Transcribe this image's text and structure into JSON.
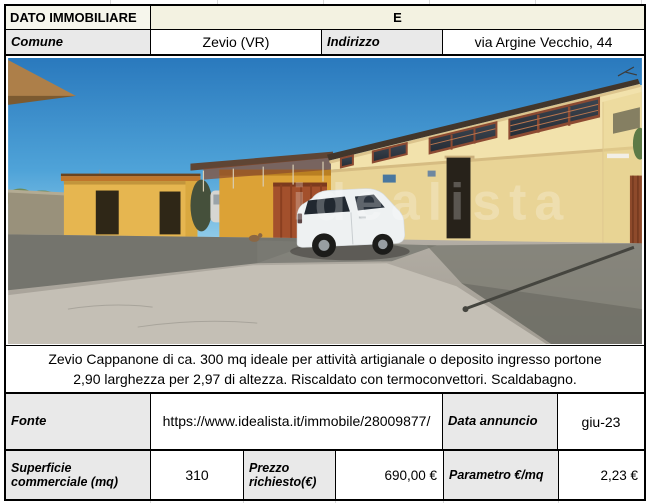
{
  "header": {
    "title": "DATO IMMOBILIARE",
    "energy_class": "E"
  },
  "location": {
    "comune_label": "Comune",
    "comune_value": "Zevio (VR)",
    "indirizzo_label": "Indirizzo",
    "indirizzo_value": "via Argine Vecchio, 44"
  },
  "photo": {
    "watermark": "idealista"
  },
  "description": {
    "line1": "Zevio Cappanone di ca. 300 mq ideale per attività artigianale o deposito ingresso portone",
    "line2": "2,90 larghezza per 2,97 di altezza. Riscaldato con termoconvettori. Scaldabagno."
  },
  "source": {
    "fonte_label": "Fonte",
    "fonte_value": "https://www.idealista.it/immobile/28009877/",
    "data_label": "Data annuncio",
    "data_value": "giu-23"
  },
  "metrics": {
    "superficie_label": "Superficie commerciale (mq)",
    "superficie_value": "310",
    "prezzo_label": "Prezzo richiesto(€)",
    "prezzo_value": "690,00 €",
    "parametro_label": "Parametro €/mq",
    "parametro_value": "2,23 €"
  },
  "colors": {
    "border": "#000000",
    "label_bg": "#e9e9e9",
    "header_bg": "#f6f6ec",
    "energy_cell_bg": "#f3f2e1",
    "sky_top": "#2a79bd",
    "building_wall": "#f0dfa8",
    "small_building": "#e6b650",
    "ground": "#aaa59c"
  }
}
